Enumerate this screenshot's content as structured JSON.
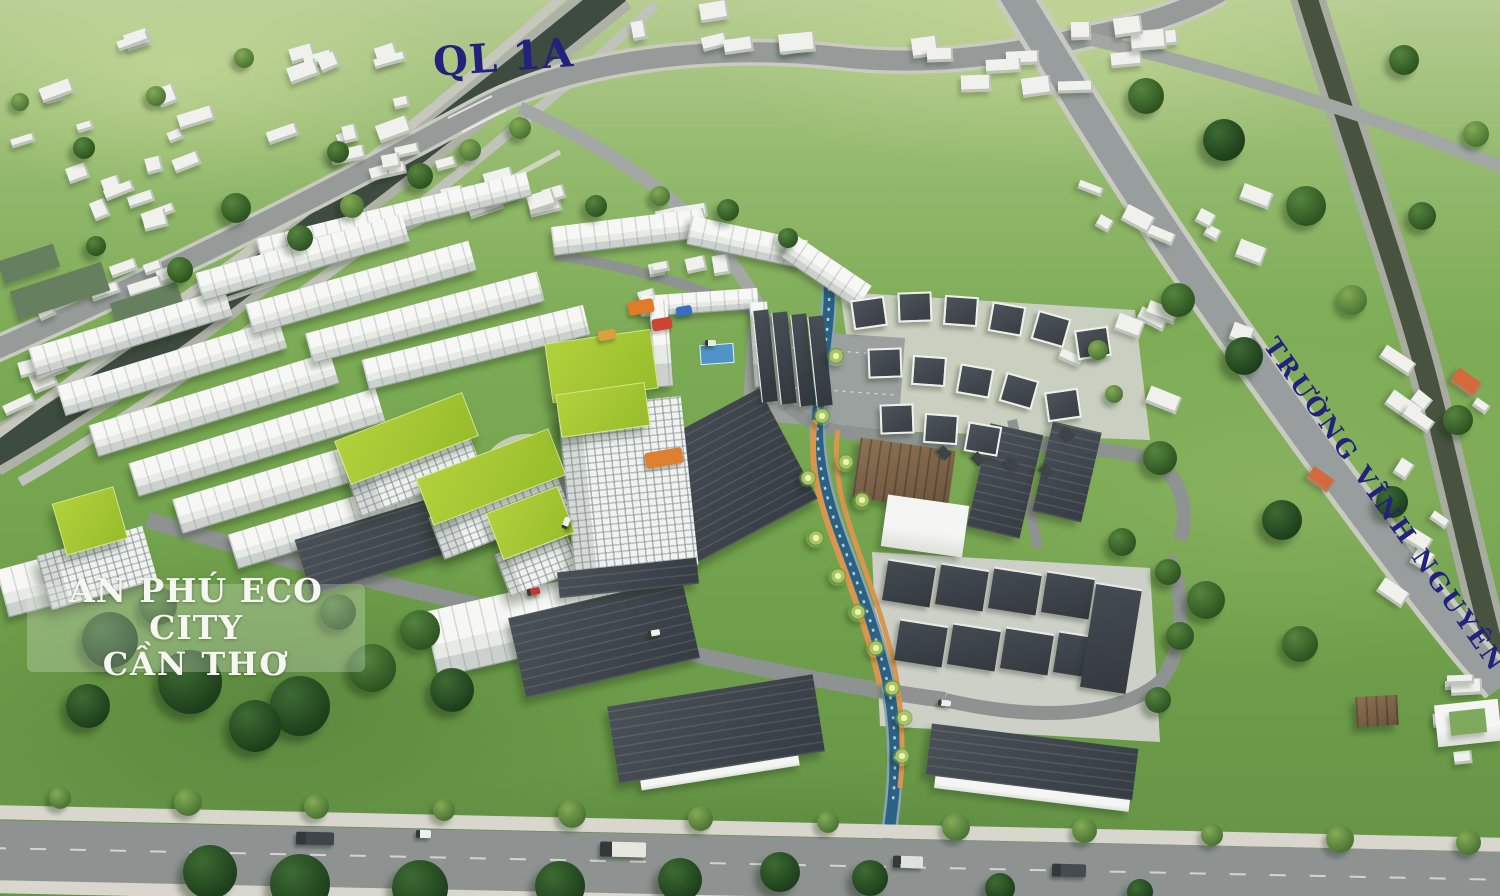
{
  "labels": {
    "road_top": "QL 1A",
    "road_right": "TRƯỜNG VĨNH NGUYÊN",
    "project_title_line1": "AN PHÚ ECO CITY",
    "project_title_line2": "CẦN THƠ"
  },
  "palette": {
    "grass": "#74a44e",
    "grass_light": "#a9c57f",
    "road": "#969b9a",
    "road_edge": "#c9cbc1",
    "sidewalk": "#d9d6cd",
    "canal_water": "#3e4b40",
    "river_water": "#47523f",
    "stream_water": "#2b6284",
    "building_white": "#f1f2ee",
    "roof_dark": "#3d434a",
    "roof_lime": "#a4c733",
    "roof_brown": "#7c6349",
    "path_orange": "#d8964f",
    "pad_gray": "#cdd0c7",
    "label_navy": "#22227c",
    "title_white": "#f5f7f0"
  }
}
